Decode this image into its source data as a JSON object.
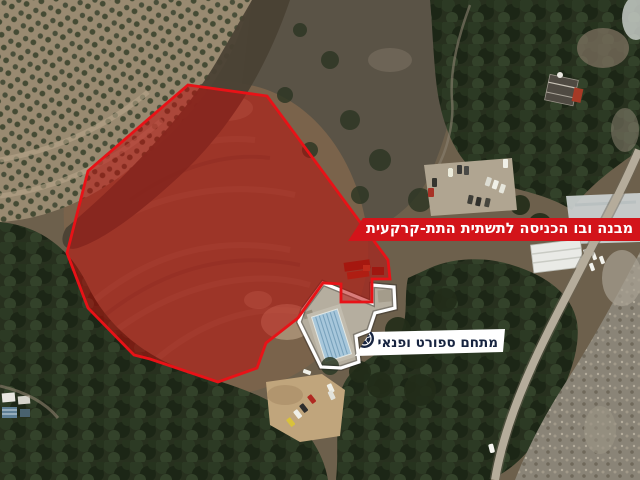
{
  "banners": {
    "underground_entrance": {
      "label": "מבנה ובו הכניסה לתשתית התת-קרקעית"
    },
    "sports_complex": {
      "label": "מתחם ספורט ופנאי",
      "icon": "soccer-ball-icon"
    }
  },
  "colors": {
    "banner_red": "#d3141a",
    "polygon_stroke": "#e81217",
    "polygon_fill": "rgba(186,16,12,0.55)",
    "banner_white": "#ffffff",
    "label_navy": "#172440",
    "label_white": "#ffffff",
    "outline_white": "#ffffff"
  }
}
